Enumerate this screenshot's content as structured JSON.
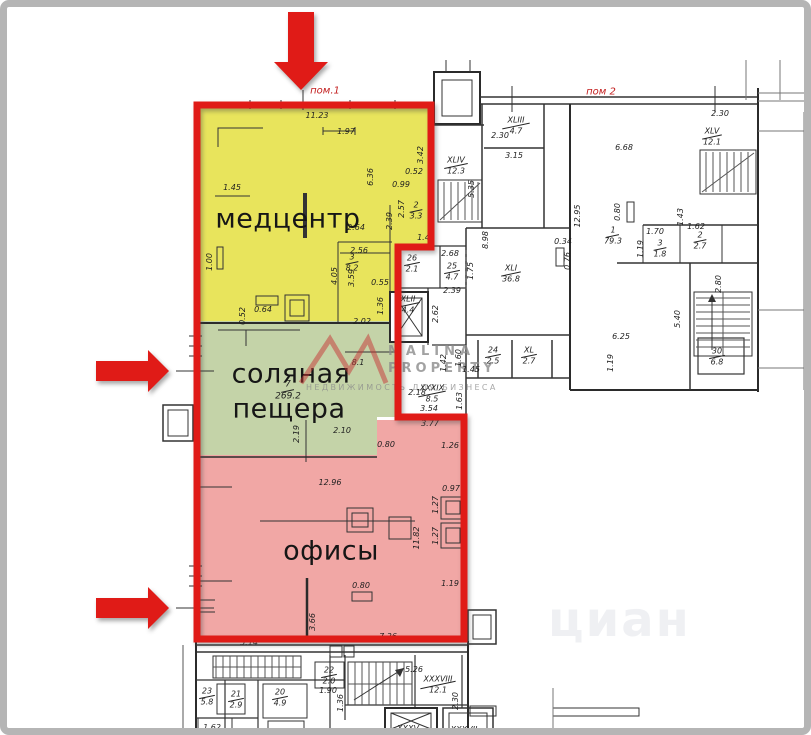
{
  "plan": {
    "premise1_label": "пом.1",
    "premise2_label": "пом 2",
    "zone_labels": {
      "medcenter": "медцентр",
      "salt_line1": "соляная",
      "salt_line2": "пещера",
      "offices": "офисы"
    },
    "zone_colors": {
      "medcenter": "#e8e45c",
      "salt": "#c4d3a8",
      "offices": "#f1a7a5",
      "outline": "#e01b17"
    },
    "dimensions": [
      {
        "t": "11.23",
        "x": 317,
        "y": 116
      },
      {
        "t": "1.97",
        "x": 346,
        "y": 132
      },
      {
        "t": "1.45",
        "x": 232,
        "y": 188
      },
      {
        "t": "3.42",
        "x": 421,
        "y": 155,
        "v": 1
      },
      {
        "t": "6.36",
        "x": 371,
        "y": 177,
        "v": 1
      },
      {
        "t": "0.52",
        "x": 414,
        "y": 172
      },
      {
        "t": "0.99",
        "x": 401,
        "y": 185
      },
      {
        "t": "2.39",
        "x": 390,
        "y": 221,
        "v": 1
      },
      {
        "t": "2.57",
        "x": 402,
        "y": 209,
        "v": 1
      },
      {
        "t": "1.42",
        "x": 426,
        "y": 238
      },
      {
        "t": "2.64",
        "x": 356,
        "y": 228
      },
      {
        "t": "2.56",
        "x": 359,
        "y": 251
      },
      {
        "t": "4.05",
        "x": 335,
        "y": 276,
        "v": 1
      },
      {
        "t": "3.59",
        "x": 352,
        "y": 278,
        "v": 1
      },
      {
        "t": "1.00",
        "x": 210,
        "y": 262,
        "v": 1
      },
      {
        "t": "0.55",
        "x": 380,
        "y": 283
      },
      {
        "t": "1.36",
        "x": 381,
        "y": 306,
        "v": 1
      },
      {
        "t": "0.52",
        "x": 243,
        "y": 316,
        "v": 1
      },
      {
        "t": "0.64",
        "x": 263,
        "y": 310
      },
      {
        "t": "2.02",
        "x": 362,
        "y": 322
      },
      {
        "t": "8.1",
        "x": 358,
        "y": 363
      },
      {
        "t": "2.10",
        "x": 342,
        "y": 431
      },
      {
        "t": "2.19",
        "x": 297,
        "y": 434,
        "v": 1
      },
      {
        "t": "2.62",
        "x": 436,
        "y": 314,
        "v": 1
      },
      {
        "t": "2.68",
        "x": 450,
        "y": 254
      },
      {
        "t": "1.75",
        "x": 471,
        "y": 271,
        "v": 1
      },
      {
        "t": "2.39",
        "x": 452,
        "y": 291
      },
      {
        "t": "8.98",
        "x": 486,
        "y": 240,
        "v": 1
      },
      {
        "t": "0.34",
        "x": 563,
        "y": 242
      },
      {
        "t": "0.76",
        "x": 568,
        "y": 261,
        "v": 1
      },
      {
        "t": "2.18",
        "x": 417,
        "y": 393
      },
      {
        "t": "1.42",
        "x": 444,
        "y": 363,
        "v": 1
      },
      {
        "t": "1.60",
        "x": 459,
        "y": 358,
        "v": 1
      },
      {
        "t": "1.45",
        "x": 471,
        "y": 370
      },
      {
        "t": "1.63",
        "x": 460,
        "y": 401,
        "v": 1
      },
      {
        "t": "3.54",
        "x": 429,
        "y": 409
      },
      {
        "t": "3.77",
        "x": 430,
        "y": 424
      },
      {
        "t": "0.80",
        "x": 386,
        "y": 445
      },
      {
        "t": "1.26",
        "x": 450,
        "y": 446
      },
      {
        "t": "12.96",
        "x": 330,
        "y": 483
      },
      {
        "t": "0.97",
        "x": 451,
        "y": 489
      },
      {
        "t": "1.27",
        "x": 436,
        "y": 505,
        "v": 1
      },
      {
        "t": "1.27",
        "x": 436,
        "y": 536,
        "v": 1
      },
      {
        "t": "11.82",
        "x": 417,
        "y": 538,
        "v": 1
      },
      {
        "t": "0.80",
        "x": 361,
        "y": 586
      },
      {
        "t": "1.19",
        "x": 450,
        "y": 584
      },
      {
        "t": "3.66",
        "x": 313,
        "y": 622,
        "v": 1
      },
      {
        "t": "7.36",
        "x": 388,
        "y": 637
      },
      {
        "t": "5.14",
        "x": 249,
        "y": 643
      },
      {
        "t": "2.30",
        "x": 500,
        "y": 136
      },
      {
        "t": "3.15",
        "x": 514,
        "y": 156
      },
      {
        "t": "5.35",
        "x": 472,
        "y": 189,
        "v": 1
      },
      {
        "t": "12.95",
        "x": 578,
        "y": 216,
        "v": 1
      },
      {
        "t": "6.68",
        "x": 624,
        "y": 148
      },
      {
        "t": "0.80",
        "x": 618,
        "y": 212,
        "v": 1
      },
      {
        "t": "1.70",
        "x": 655,
        "y": 232
      },
      {
        "t": "1.43",
        "x": 681,
        "y": 217,
        "v": 1
      },
      {
        "t": "1.62",
        "x": 696,
        "y": 227
      },
      {
        "t": "1.19",
        "x": 641,
        "y": 249,
        "v": 1
      },
      {
        "t": "2.30",
        "x": 720,
        "y": 114
      },
      {
        "t": "2.80",
        "x": 719,
        "y": 284,
        "v": 1
      },
      {
        "t": "5.40",
        "x": 678,
        "y": 319,
        "v": 1
      },
      {
        "t": "6.25",
        "x": 621,
        "y": 337
      },
      {
        "t": "1.19",
        "x": 611,
        "y": 363,
        "v": 1
      },
      {
        "t": "1.90",
        "x": 328,
        "y": 691
      },
      {
        "t": "1.36",
        "x": 341,
        "y": 703,
        "v": 1
      },
      {
        "t": "5.26",
        "x": 414,
        "y": 670
      },
      {
        "t": "2.30",
        "x": 456,
        "y": 701,
        "v": 1
      },
      {
        "t": "1.62",
        "x": 212,
        "y": 728
      },
      {
        "t": "XXXV",
        "x": 408,
        "y": 729
      },
      {
        "t": "XXXVII",
        "x": 464,
        "y": 730
      }
    ],
    "rooms": [
      {
        "n": "2",
        "a": "3.3",
        "x": 416,
        "y": 211
      },
      {
        "n": "3",
        "a": "8.2",
        "x": 352,
        "y": 263
      },
      {
        "n": "7",
        "a": "269.2",
        "x": 288,
        "y": 391,
        "fs": 9
      },
      {
        "n": "26",
        "a": "2.1",
        "x": 412,
        "y": 264
      },
      {
        "n": "25",
        "a": "4.7",
        "x": 452,
        "y": 272
      },
      {
        "n": "XLI",
        "a": "36.8",
        "x": 511,
        "y": 274
      },
      {
        "n": "XLII",
        "a": "4.4",
        "x": 408,
        "y": 305
      },
      {
        "n": "24",
        "a": "2.5",
        "x": 493,
        "y": 356
      },
      {
        "n": "XL",
        "a": "2.7",
        "x": 529,
        "y": 356
      },
      {
        "n": "XXXIX",
        "a": "8.5",
        "x": 432,
        "y": 394
      },
      {
        "n": "XLIII",
        "a": "4.7",
        "x": 516,
        "y": 126
      },
      {
        "n": "XLIV",
        "a": "12.3",
        "x": 456,
        "y": 166
      },
      {
        "n": "XLV",
        "a": "12.1",
        "x": 712,
        "y": 137
      },
      {
        "n": "1",
        "a": "79.3",
        "x": 613,
        "y": 236
      },
      {
        "n": "3",
        "a": "1.8",
        "x": 660,
        "y": 249
      },
      {
        "n": "2",
        "a": "2.7",
        "x": 700,
        "y": 241
      },
      {
        "n": "30",
        "a": "6.8",
        "x": 717,
        "y": 357
      },
      {
        "n": "23",
        "a": "5.8",
        "x": 207,
        "y": 697
      },
      {
        "n": "21",
        "a": "2.9",
        "x": 236,
        "y": 700
      },
      {
        "n": "20",
        "a": "4.9",
        "x": 280,
        "y": 698
      },
      {
        "n": "22",
        "a": "2.0",
        "x": 329,
        "y": 676
      },
      {
        "n": "XXXVIII",
        "a": "12.1",
        "x": 438,
        "y": 685
      }
    ]
  },
  "annotations": {
    "arrow_color": "#e01b17",
    "arrows": [
      {
        "id": "top",
        "direction": "down"
      },
      {
        "id": "middle-left",
        "direction": "right"
      },
      {
        "id": "bottom-left",
        "direction": "right"
      }
    ]
  },
  "watermarks": {
    "brand_line1": "MALINA",
    "brand_line2": "PROPERTY",
    "tagline": "НЕДВИЖИМОСТЬ ДЛЯ БИЗНЕСА",
    "corner": "циан",
    "logo_color": "#c63434"
  }
}
